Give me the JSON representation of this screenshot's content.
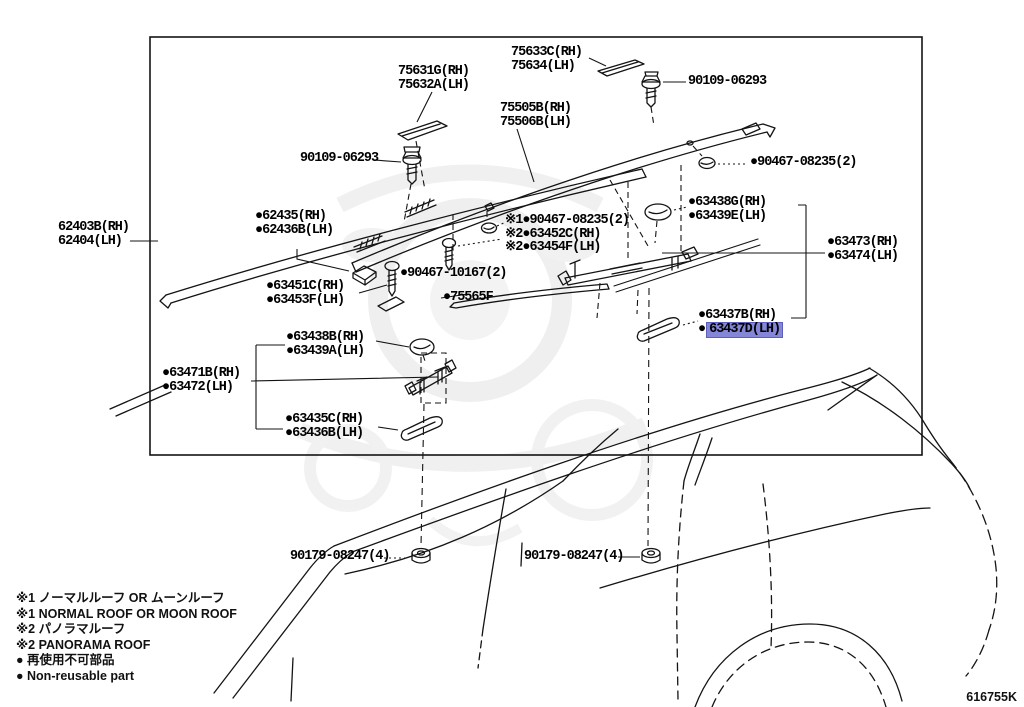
{
  "diagram_code": "616755K",
  "colors": {
    "highlight": "#8486d8",
    "highlight_border": "#5d5fbe",
    "line": "#141414",
    "watermark": "#e6e6e6"
  },
  "labels": {
    "p75631": [
      "75631G(RH)",
      "75632A(LH)"
    ],
    "p75633": [
      "75633C(RH)",
      "75634(LH)"
    ],
    "p90109_top": "90109-06293",
    "p75505": [
      "75505B(RH)",
      "75506B(LH)"
    ],
    "p90109_left": "90109-06293",
    "p90467_08235_right": "●90467-08235(2)",
    "p62403": [
      "62403B(RH)",
      "62404(LH)"
    ],
    "p62435": [
      "●62435(RH)",
      "●62436B(LH)"
    ],
    "p_star": [
      "※1●90467-08235(2)",
      "※2●63452C(RH)",
      "※2●63454F(LH)"
    ],
    "p63438G": [
      "●63438G(RH)",
      "●63439E(LH)"
    ],
    "p63473": [
      "●63473(RH)",
      "●63474(LH)"
    ],
    "p63451": [
      "●63451C(RH)",
      "●63453F(LH)"
    ],
    "p90467_10167": "●90467-10167(2)",
    "p75565": "●75565F",
    "p63437B": "●63437B(RH)",
    "p63437D_bullet": "●",
    "p63437D": "63437D(LH)",
    "p63438B": [
      "●63438B(RH)",
      "●63439A(LH)"
    ],
    "p63471": [
      "●63471B(RH)",
      "●63472(LH)"
    ],
    "p63435": [
      "●63435C(RH)",
      "●63436B(LH)"
    ],
    "p90179_left": "90179-08247(4)",
    "p90179_right": "90179-08247(4)"
  },
  "legend": [
    "※1 ノーマルルーフ  OR  ムーンルーフ",
    "※1 NORMAL ROOF OR MOON ROOF",
    "※2 パノラマルーフ",
    "※2 PANORAMA ROOF",
    "● 再使用不可部品",
    "● Non-reusable part"
  ]
}
